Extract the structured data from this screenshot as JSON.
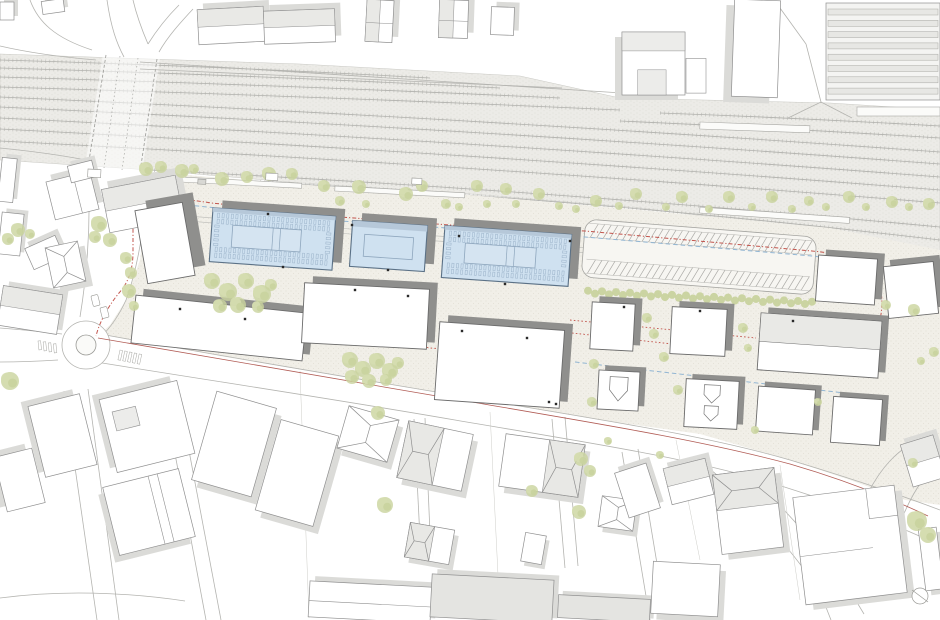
{
  "scene": {
    "w": 940,
    "h": 620
  },
  "palette": {
    "bg": "#ffffff",
    "plaza": "#f1efe8",
    "plaza_dot": "#ddd9cd",
    "ballast": "#ecebe7",
    "ballast_dot": "#dcdbd4",
    "track_rail": "#b1b1ad",
    "track_tie": "#cfcfca",
    "road_line": "#b4b4b0",
    "thin_line": "#cdcdc8",
    "site_stroke": "#6b6b6b",
    "site_shadow": "#8f8f8d",
    "ctx_stroke": "#8f8f8f",
    "ctx_shadow": "#dbdbd8",
    "ctx_tone": "#e9e9e6",
    "blue_fill": "#cfe1f0",
    "blue_stroke": "#5b7186",
    "blue_band": "#b6c8d9",
    "blue_inner": "#8ea6bd",
    "tree_a": "#c9d39e",
    "tree_b": "#d5ddb0",
    "hedge": "#c6d09a",
    "red_dash": "#c2544c",
    "red_solid": "#a84a42",
    "blue_dashline": "#92b6d3",
    "dot": "#2a2a2a",
    "gray_fill": "#e4e4e1"
  },
  "railway": {
    "ballast_poly": "0,54 300,64 520,76 620,98 830,103 940,110 940,266 830,232 640,208 470,194 300,183 150,170 0,160",
    "tracks": [
      [
        0,
        60,
        215,
        66,
        430,
        78
      ],
      [
        0,
        68,
        250,
        75,
        500,
        88
      ],
      [
        0,
        77,
        280,
        85,
        560,
        98
      ],
      [
        0,
        87,
        310,
        96,
        620,
        110
      ],
      [
        0,
        97,
        470,
        118,
        940,
        152
      ],
      [
        0,
        107,
        470,
        129,
        940,
        164
      ],
      [
        0,
        118,
        470,
        141,
        940,
        177
      ],
      [
        0,
        129,
        470,
        153,
        940,
        190
      ],
      [
        0,
        141,
        470,
        165,
        940,
        203
      ],
      [
        660,
        113,
        800,
        118,
        940,
        126
      ],
      [
        620,
        121,
        780,
        128,
        940,
        138
      ],
      [
        150,
        170,
        545,
        190,
        940,
        227
      ],
      [
        260,
        182,
        600,
        200,
        940,
        240
      ],
      [
        420,
        200,
        680,
        215,
        940,
        253
      ],
      [
        620,
        222,
        780,
        235,
        940,
        261
      ]
    ],
    "crossing_poly": "103,54 160,58 142,172 85,166",
    "crossing_edges": [
      "M 106,55 L 88,167",
      "M 157,59 L 140,172"
    ],
    "crossing_inner": [
      "M 120,56 L 104,168",
      "M 138,58 L 122,170"
    ]
  },
  "plaza_poly": "150,172 320,186 470,195 640,210 830,228 940,250 940,505 905,500 850,480 790,460 700,434 600,420 460,396 340,376 220,356 100,334 110,325 126,300 140,260 146,210 148,172",
  "platform_lines": [
    "M 150,213 L 600,249",
    "M 150,218 L 600,254"
  ],
  "platforms": [
    [
      162,
      176,
      140,
      5,
      3
    ],
    [
      335,
      186,
      130,
      5,
      3
    ],
    [
      700,
      207,
      150,
      6,
      4
    ],
    [
      857,
      107,
      83,
      9,
      0
    ],
    [
      700,
      122,
      110,
      7,
      2
    ]
  ],
  "roads": [
    "M 30,0 C 38,22 55,38 92,50",
    "M 0,46 C 30,53 60,57 96,60",
    "M 107,0 C 111,28 117,44 124,57",
    "M 133,0 C 137,17 142,30 148,44",
    "M 148,44 C 158,28 168,16 179,5",
    "M 193,9 C 181,22 168,36 159,52",
    "M 140,62 L 622,93",
    "M 140,69 L 562,88",
    "M 88,168 C 91,220 88,268 80,317",
    "M 148,172 C 146,212 140,262 126,300 C 118,318 108,330 100,338",
    "M 0,328 C 25,330 45,332 62,334",
    "M 0,362 C 24,362 42,361 58,360",
    "M 100,334 C 220,356 340,376 460,396 C 600,420 700,434 790,460 C 850,478 900,495 940,510",
    "M 96,362 C 220,382 340,400 455,420 C 590,443 690,458 775,484 C 835,503 885,520 928,540",
    "M 162,384 L 206,620",
    "M 176,382 L 221,620",
    "M 64,391 L 97,620",
    "M 88,389 L 119,620",
    "M 414,419 L 421,558",
    "M 425,418 L 431,556",
    "M 552,419 L 565,568",
    "M 565,417 L 578,566",
    "M 622,452 L 650,620",
    "M 638,449 L 666,618",
    "M 700,461 C 742,494 788,544 820,592 L 831,620",
    "M 747,472 C 792,516 836,566 864,614",
    "M 868,493 C 880,470 893,455 908,446",
    "M 903,516 C 913,492 924,475 938,464",
    "M 806,44 L 821,102",
    "M 821,102 L 852,118",
    "M 821,102 L 788,118",
    "M 780,8 L 806,44",
    "M 0,148 C 30,151 60,155 86,160",
    "M 0,598 C 60,590 125,592 185,601"
  ],
  "thin_lines": [
    "M 300,371 L 309,618",
    "M 490,412 L 498,575",
    "M 676,440 L 700,560",
    "M 780,465 L 800,600"
  ],
  "road_fills": [
    {
      "d": "M 0,597 C 60,589 125,591 185,601 L 185,620 L 0,620 Z",
      "fill": "#ffffff"
    }
  ],
  "roundabout": {
    "cx": 86,
    "cy": 345,
    "r_outer": 24,
    "r_island": 10
  },
  "boundaries": {
    "red_dash": [
      "M 133,192 L 133,252 C 133,270 128,283 119,293 C 110,304 100,320 96,336",
      "M 133,192 L 212,203 L 340,217 L 450,225 L 585,231 L 812,251 C 852,255 872,263 878,279 C 883,294 883,310 879,323 C 874,344 866,360 853,372"
    ],
    "red_dotted": [
      "M 136,302 C 152,298 170,298 186,302 C 240,314 300,327 352,334",
      "M 352,334 L 430,348 L 560,356",
      "M 570,320 L 756,338",
      "M 572,333 L 700,347"
    ],
    "red_solid": [
      "M 98,338 C 220,360 340,380 460,400 C 600,424 700,440 790,464 C 845,480 890,498 928,516"
    ],
    "blue_dash": [
      "M 150,201 L 340,221 L 585,237 L 812,256 C 840,259 856,266 862,276",
      "M 575,362 L 888,398"
    ]
  },
  "parking": {
    "x": 583,
    "y": 228,
    "w": 232,
    "h": 58,
    "rot": 4.5,
    "band1": [
      4,
      18
    ],
    "band2": [
      40,
      54
    ],
    "stripe_step": 6.5
  },
  "hedge": {
    "x1": 588,
    "y1": 292,
    "x2": 812,
    "y2": 303,
    "r": 4,
    "step": 7
  },
  "buildings": {
    "site": [
      [
        "w1",
        141,
        206,
        48,
        74,
        -10,
        "plain",
        12,
        -8
      ],
      [
        "b1",
        211,
        212,
        123,
        54,
        4,
        "blue-panel",
        9,
        -8
      ],
      [
        "b2",
        351,
        223,
        75,
        46,
        4,
        "blue-plain",
        9,
        -8
      ],
      [
        "b3",
        443,
        230,
        127,
        52,
        4,
        "blue-panel",
        9,
        -8
      ],
      [
        "w2",
        133,
        304,
        172,
        48,
        6,
        "plain",
        7,
        -7
      ],
      [
        "w3",
        303,
        286,
        125,
        60,
        3,
        "plain",
        8,
        -7
      ],
      [
        "w4",
        437,
        326,
        125,
        78,
        4,
        "plain",
        8,
        -7
      ],
      [
        "s1",
        591,
        303,
        43,
        47,
        3,
        "plain",
        7,
        -6
      ],
      [
        "s2",
        671,
        308,
        55,
        47,
        3,
        "plain",
        7,
        -6
      ],
      [
        "s3",
        759,
        317,
        121,
        57,
        4,
        "two-tone-h",
        7,
        -6
      ],
      [
        "h1",
        598,
        371,
        41,
        39,
        3,
        "gable-house",
        6,
        -5
      ],
      [
        "h2",
        685,
        380,
        53,
        48,
        3,
        "gable-house2",
        6,
        -5
      ],
      [
        "h3",
        757,
        388,
        57,
        45,
        4,
        "plain",
        6,
        -5
      ],
      [
        "h4",
        832,
        398,
        49,
        46,
        4,
        "plain",
        6,
        -5
      ],
      [
        "e1",
        817,
        257,
        59,
        46,
        4,
        "plain",
        7,
        -6
      ],
      [
        "e2",
        886,
        264,
        50,
        52,
        -6,
        "plain",
        7,
        -6
      ]
    ],
    "context": [
      [
        "c1",
        198,
        8,
        66,
        35,
        -3,
        "two-tone-h",
        6,
        -6
      ],
      [
        "c2",
        264,
        10,
        71,
        33,
        -2,
        "two-tone-h",
        6,
        -6
      ],
      [
        "c3",
        366,
        0,
        27,
        42,
        3,
        "two-tone-v",
        6,
        -6
      ],
      [
        "c4",
        439,
        0,
        29,
        38,
        2,
        "two-tone-v",
        6,
        -6
      ],
      [
        "c5",
        491,
        7,
        23,
        28,
        2,
        "plain",
        5,
        -5
      ],
      [
        "c6",
        622,
        32,
        63,
        63,
        0,
        "station",
        -7,
        5
      ],
      [
        "c7",
        733,
        0,
        46,
        97,
        2,
        "plain",
        -8,
        6
      ],
      [
        "c8",
        826,
        3,
        114,
        97,
        0,
        "strips",
        0,
        0
      ],
      [
        "c9",
        0,
        2,
        14,
        18,
        0,
        "plain",
        4,
        -4
      ],
      [
        "c10",
        42,
        0,
        22,
        13,
        -8,
        "plain",
        4,
        -4
      ],
      [
        "c11",
        50,
        176,
        45,
        39,
        -14,
        "split-v",
        6,
        -6
      ],
      [
        "c12",
        105,
        182,
        75,
        44,
        -11,
        "two-tone-h",
        7,
        -7
      ],
      [
        "c13",
        69,
        163,
        25,
        17,
        -14,
        "plain",
        4,
        -4
      ],
      [
        "c15",
        0,
        158,
        15,
        44,
        6,
        "plain",
        4,
        -4
      ],
      [
        "c16",
        0,
        213,
        22,
        42,
        6,
        "plain",
        4,
        -4
      ],
      [
        "c17",
        28,
        241,
        33,
        23,
        -24,
        "plain",
        5,
        -5
      ],
      [
        "c18",
        49,
        244,
        33,
        41,
        -12,
        "gable-v",
        6,
        6
      ],
      [
        "c19",
        0,
        290,
        60,
        40,
        9,
        "two-tone-h",
        5,
        -5
      ],
      [
        "c21",
        36,
        399,
        53,
        73,
        -14,
        "plain",
        -6,
        -6
      ],
      [
        "c22",
        0,
        452,
        39,
        56,
        -14,
        "plain",
        -6,
        -6
      ],
      [
        "c24",
        107,
        389,
        80,
        75,
        -14,
        "courtyard",
        -6,
        -6
      ],
      [
        "c25",
        110,
        477,
        78,
        70,
        -14,
        "split-v2",
        -6,
        6
      ],
      [
        "c26a",
        203,
        398,
        62,
        92,
        16,
        "plain",
        7,
        6
      ],
      [
        "c26b",
        267,
        426,
        60,
        94,
        16,
        "plain",
        7,
        6
      ],
      [
        "c27",
        342,
        412,
        52,
        44,
        16,
        "gable-v",
        6,
        6
      ],
      [
        "c28",
        402,
        427,
        66,
        58,
        12,
        "hip-l",
        6,
        6
      ],
      [
        "c29",
        502,
        439,
        80,
        53,
        8,
        "hip-r",
        6,
        6
      ],
      [
        "c30",
        407,
        526,
        45,
        35,
        10,
        "hip-l",
        5,
        5
      ],
      [
        "c31",
        523,
        534,
        21,
        29,
        10,
        "plain",
        4,
        4
      ],
      [
        "c32",
        600,
        498,
        35,
        31,
        8,
        "gable-v",
        5,
        5
      ],
      [
        "c33",
        309,
        584,
        122,
        36,
        3,
        "split-h",
        5,
        -5
      ],
      [
        "c34",
        431,
        577,
        122,
        43,
        3,
        "gray",
        5,
        -5
      ],
      [
        "c35",
        558,
        597,
        92,
        23,
        3,
        "gray",
        4,
        -4
      ],
      [
        "c36",
        652,
        563,
        67,
        52,
        3,
        "plain",
        6,
        6
      ],
      [
        "c37",
        621,
        467,
        33,
        47,
        -18,
        "plain",
        5,
        -5
      ],
      [
        "c38",
        667,
        463,
        43,
        37,
        -14,
        "two-tone-h",
        5,
        -5
      ],
      [
        "c39",
        717,
        471,
        62,
        80,
        -7,
        "hip-top",
        6,
        6
      ],
      [
        "c40",
        799,
        491,
        102,
        108,
        -7,
        "lshape",
        7,
        6
      ],
      [
        "c41",
        906,
        439,
        34,
        44,
        -17,
        "two-tone-h",
        5,
        -5
      ],
      [
        "c42",
        922,
        528,
        18,
        62,
        -7,
        "plain",
        5,
        5
      ]
    ]
  },
  "trees": [
    [
      146,
      169,
      7
    ],
    [
      161,
      167,
      6
    ],
    [
      182,
      171,
      7
    ],
    [
      194,
      169,
      5
    ],
    [
      222,
      179,
      7
    ],
    [
      247,
      177,
      6
    ],
    [
      269,
      174,
      7
    ],
    [
      292,
      174,
      6
    ],
    [
      324,
      186,
      6
    ],
    [
      340,
      201,
      5
    ],
    [
      359,
      187,
      7
    ],
    [
      366,
      204,
      4
    ],
    [
      406,
      194,
      7
    ],
    [
      422,
      186,
      6
    ],
    [
      446,
      204,
      5
    ],
    [
      459,
      207,
      4
    ],
    [
      477,
      186,
      6
    ],
    [
      487,
      204,
      4
    ],
    [
      506,
      189,
      6
    ],
    [
      516,
      204,
      4
    ],
    [
      539,
      194,
      6
    ],
    [
      559,
      206,
      4
    ],
    [
      576,
      209,
      4
    ],
    [
      596,
      201,
      6
    ],
    [
      619,
      206,
      4
    ],
    [
      636,
      194,
      6
    ],
    [
      666,
      207,
      4
    ],
    [
      682,
      197,
      6
    ],
    [
      709,
      209,
      4
    ],
    [
      729,
      197,
      6
    ],
    [
      752,
      207,
      4
    ],
    [
      772,
      197,
      6
    ],
    [
      792,
      209,
      4
    ],
    [
      809,
      201,
      5
    ],
    [
      826,
      207,
      4
    ],
    [
      849,
      197,
      6
    ],
    [
      866,
      207,
      4
    ],
    [
      892,
      202,
      6
    ],
    [
      909,
      207,
      4
    ],
    [
      929,
      204,
      6
    ],
    [
      99,
      224,
      8
    ],
    [
      110,
      240,
      7
    ],
    [
      95,
      237,
      6
    ],
    [
      18,
      230,
      7
    ],
    [
      8,
      239,
      6
    ],
    [
      30,
      234,
      5
    ],
    [
      126,
      258,
      6
    ],
    [
      131,
      273,
      6
    ],
    [
      129,
      291,
      7
    ],
    [
      134,
      306,
      5
    ],
    [
      212,
      281,
      8
    ],
    [
      228,
      292,
      9
    ],
    [
      246,
      281,
      8
    ],
    [
      262,
      294,
      9
    ],
    [
      238,
      305,
      8
    ],
    [
      220,
      306,
      7
    ],
    [
      258,
      307,
      6
    ],
    [
      271,
      285,
      6
    ],
    [
      350,
      360,
      8
    ],
    [
      363,
      369,
      8
    ],
    [
      377,
      361,
      8
    ],
    [
      390,
      371,
      8
    ],
    [
      352,
      377,
      7
    ],
    [
      369,
      381,
      7
    ],
    [
      386,
      380,
      6
    ],
    [
      398,
      363,
      6
    ],
    [
      594,
      364,
      5
    ],
    [
      592,
      402,
      5
    ],
    [
      647,
      318,
      5
    ],
    [
      654,
      334,
      5
    ],
    [
      664,
      357,
      5
    ],
    [
      678,
      390,
      5
    ],
    [
      743,
      328,
      5
    ],
    [
      748,
      348,
      4
    ],
    [
      818,
      402,
      4
    ],
    [
      755,
      430,
      4
    ],
    [
      608,
      441,
      4
    ],
    [
      660,
      455,
      4
    ],
    [
      10,
      381,
      9
    ],
    [
      378,
      413,
      7
    ],
    [
      385,
      505,
      8
    ],
    [
      532,
      491,
      6
    ],
    [
      581,
      459,
      7
    ],
    [
      590,
      471,
      6
    ],
    [
      579,
      512,
      7
    ],
    [
      913,
      463,
      5
    ],
    [
      917,
      521,
      10
    ],
    [
      928,
      535,
      8
    ],
    [
      886,
      305,
      5
    ],
    [
      914,
      310,
      6
    ],
    [
      934,
      352,
      5
    ],
    [
      921,
      361,
      4
    ]
  ],
  "details": {
    "door_dots": [
      [
        268,
        214
      ],
      [
        283,
        267
      ],
      [
        388,
        270
      ],
      [
        459,
        236
      ],
      [
        505,
        284
      ],
      [
        355,
        290
      ],
      [
        408,
        296
      ],
      [
        180,
        309
      ],
      [
        245,
        319
      ],
      [
        462,
        331
      ],
      [
        527,
        338
      ],
      [
        549,
        402
      ],
      [
        556,
        404
      ],
      [
        793,
        321
      ],
      [
        624,
        307
      ],
      [
        700,
        311
      ],
      [
        352,
        225
      ],
      [
        570,
        241
      ]
    ],
    "cars": [
      [
        92,
        295,
        7,
        11,
        -14
      ],
      [
        101,
        307,
        7,
        11,
        -14
      ]
    ],
    "huts": [
      [
        88,
        169,
        13,
        8,
        3,
        "#ffffff"
      ],
      [
        198,
        179,
        8,
        5,
        3,
        "#d8d8d4"
      ],
      [
        266,
        173,
        12,
        7,
        3,
        "#ffffff"
      ],
      [
        412,
        178,
        10,
        6,
        3,
        "#ffffff"
      ]
    ],
    "zebra_west": {
      "xs": [
        38,
        43,
        48,
        53
      ],
      "y": 341,
      "w": 2.6,
      "h": 9,
      "rot": -6,
      "dy": 1
    },
    "zebra_street": {
      "xs": [
        120,
        125,
        130,
        135,
        140
      ],
      "y": 350,
      "w": 2.6,
      "h": 10,
      "rot": 12,
      "dy": 1
    },
    "survey_circle": {
      "cx": 920,
      "cy": 596,
      "r": 8,
      "tick": "M 912,590 L 928,602"
    }
  }
}
